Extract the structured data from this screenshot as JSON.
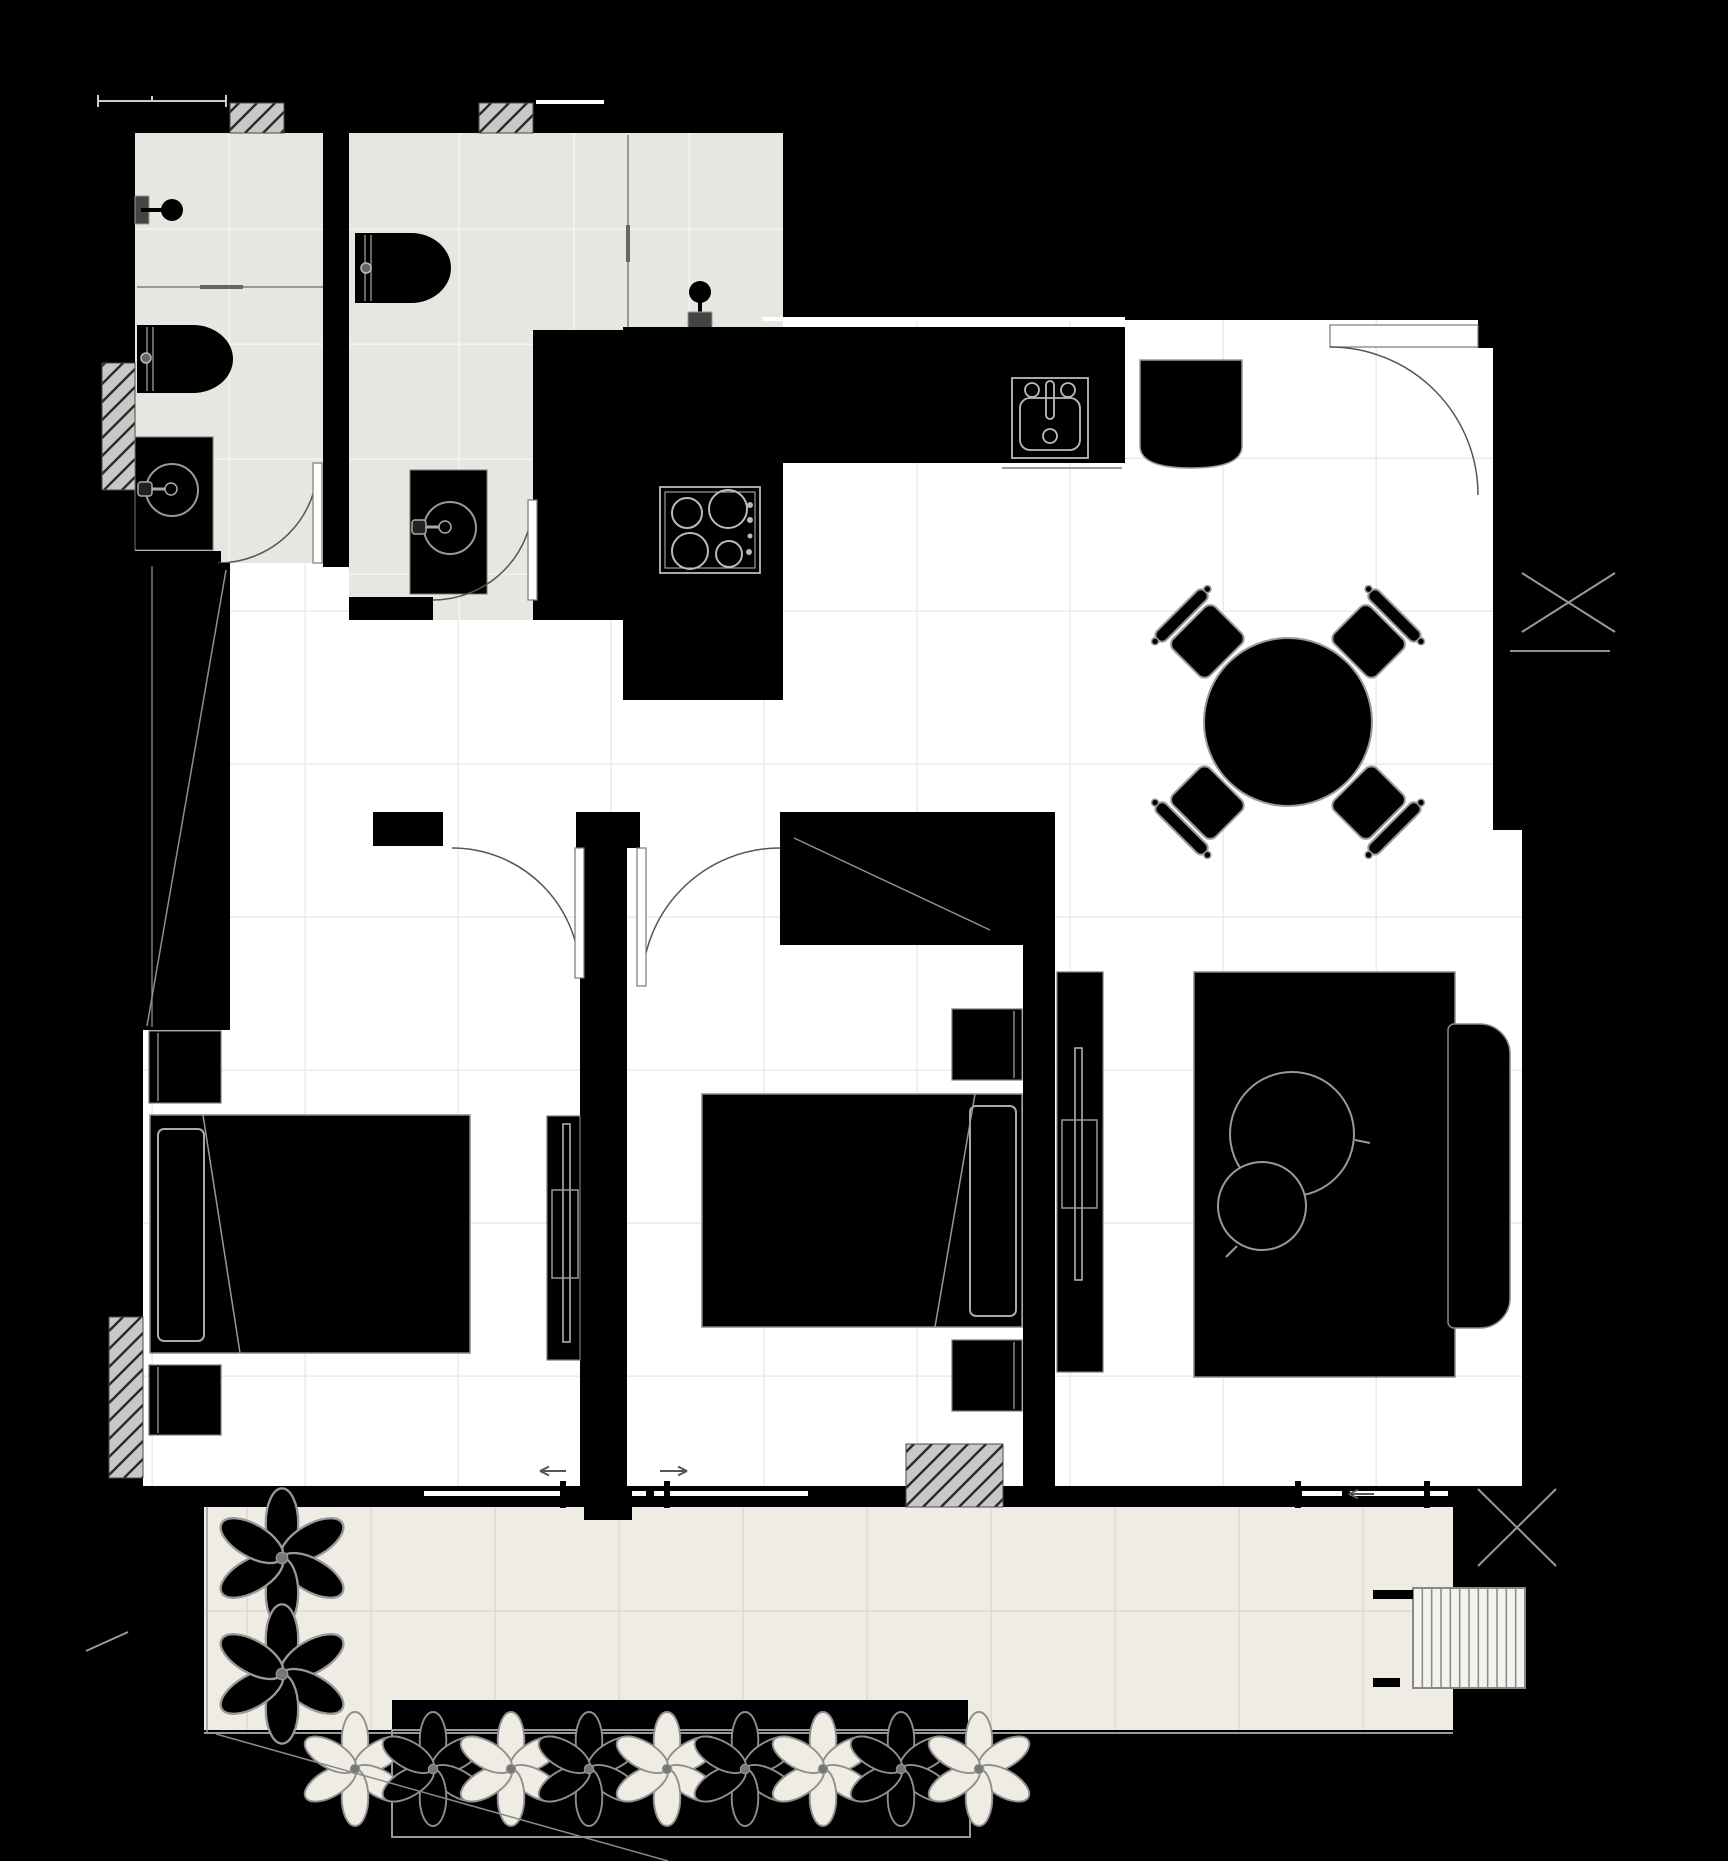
{
  "document": {
    "kind": "architectural-floor-plan",
    "style": "black-walls-white-floors",
    "visible_text": []
  },
  "colors": {
    "bg": "#000000",
    "floorMain": "#ffffff",
    "gridMain": "#ececec",
    "floorBath": "#e7e7e1",
    "gridBath": "#f4f4ef",
    "floorBalc": "#efece4",
    "gridBalc": "#e1dcd0",
    "hatchFill": "#c8c8c8",
    "hatchLine": "#2a2a2a",
    "ink": "#000000",
    "outline": "#8f8f8f",
    "outlineLight": "#bbbbbb",
    "thin": "#999999",
    "dark": "#555555",
    "sill": "#cccccc"
  },
  "rooms": [
    {
      "name": "bathroom-1"
    },
    {
      "name": "bathroom-2"
    },
    {
      "name": "hallway"
    },
    {
      "name": "kitchen"
    },
    {
      "name": "living-dining-room"
    },
    {
      "name": "bedroom-1"
    },
    {
      "name": "bedroom-2"
    },
    {
      "name": "balcony"
    }
  ],
  "furniture": [
    "toilet",
    "shower",
    "vanity-sink",
    "wardrobe",
    "kitchen-counter",
    "cooktop",
    "kitchen-sink",
    "fridge",
    "dining-table",
    "dining-chair",
    "double-bed",
    "nightstand",
    "tv-console",
    "rug",
    "sofa",
    "side-table",
    "planter",
    "plant",
    "stairs"
  ],
  "dining": {
    "cx": 1288,
    "cy": 722,
    "table_r": 84,
    "chair_angles": [
      45,
      135,
      225,
      315
    ]
  },
  "corner_plants": {
    "cx": 282,
    "cys": [
      1558,
      1674
    ],
    "scale": 1.16
  },
  "planter_row": {
    "count": 9,
    "start_x": 355,
    "step_x": 78,
    "cy": 1769,
    "scale": 0.95,
    "first": "light"
  },
  "stairs": {
    "x": 1413,
    "y": 1588,
    "width": 112,
    "height": 100,
    "treads": 12
  },
  "arrows": [
    {
      "name": "bedroom-1-slide-arrow",
      "x1": 566,
      "y1": 1471,
      "x2": 540,
      "y2": 1471
    },
    {
      "name": "bedroom-2-slide-arrow",
      "x1": 660,
      "y1": 1471,
      "x2": 687,
      "y2": 1471
    },
    {
      "name": "balcony-door-arrow",
      "x1": 1374,
      "y1": 1494,
      "x2": 1349,
      "y2": 1494
    }
  ],
  "x_markers": [
    {
      "name": "shaft-marker-upper",
      "x1": 1522,
      "y1": 573,
      "x2": 1615,
      "y2": 632
    },
    {
      "name": "shaft-marker-lower",
      "x1": 1478,
      "y1": 1489,
      "x2": 1556,
      "y2": 1566
    }
  ]
}
